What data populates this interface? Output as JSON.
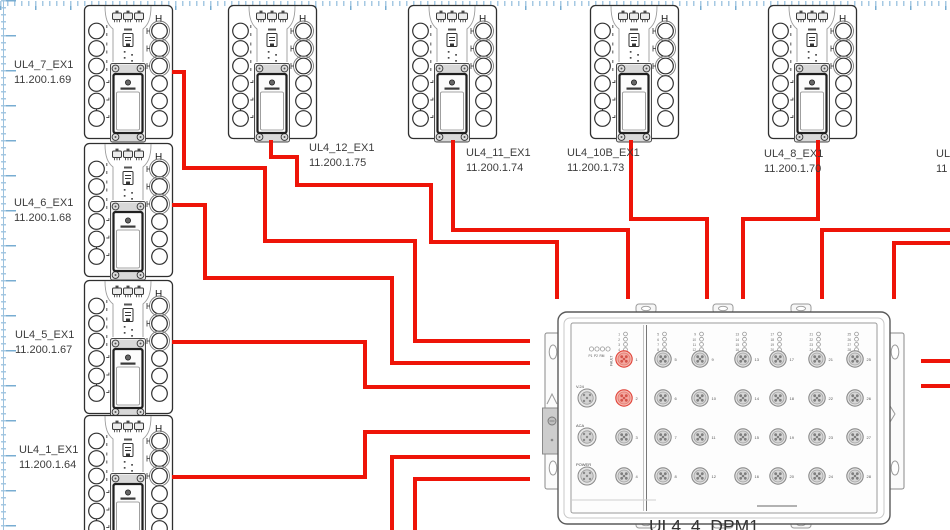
{
  "canvas": {
    "width": 950,
    "height": 530,
    "background": "#ffffff",
    "grid_tick_color": "#a6c9e3",
    "grid_major_color": "#78add2",
    "cable_color": "#ee1408",
    "highlight_port_fill": "#f6b9b1"
  },
  "ex_marker": "H",
  "devices": [
    {
      "name": "UL4_7_EX1",
      "ip": "11.200.1.69",
      "x": 84,
      "y": 5,
      "label_x": 14,
      "label_y": 58,
      "cable_exit": "right"
    },
    {
      "name": "UL4_6_EX1",
      "ip": "11.200.1.68",
      "x": 84,
      "y": 143,
      "label_x": 14,
      "label_y": 196,
      "cable_exit": "right"
    },
    {
      "name": "UL4_5_EX1",
      "ip": "11.200.1.67",
      "x": 84,
      "y": 280,
      "label_x": 15,
      "label_y": 328,
      "cable_exit": "right"
    },
    {
      "name": "UL4_1_EX1",
      "ip": "11.200.1.64",
      "x": 84,
      "y": 415,
      "label_x": 19,
      "label_y": 443,
      "cable_exit": "right"
    },
    {
      "name": "UL4_12_EX1",
      "ip": "11.200.1.75",
      "x": 228,
      "y": 5,
      "label_x": 309,
      "label_y": 141,
      "cable_exit": "bottom"
    },
    {
      "name": "UL4_11_EX1",
      "ip": "11.200.1.74",
      "x": 408,
      "y": 5,
      "label_x": 466,
      "label_y": 146,
      "cable_exit": "bottom"
    },
    {
      "name": "UL4_10B_EX1",
      "ip": "11.200.1.73",
      "x": 590,
      "y": 5,
      "label_x": 567,
      "label_y": 146,
      "cable_exit": "bottom"
    },
    {
      "name": "UL4_8_EX1",
      "ip": "11.200.1.70",
      "x": 768,
      "y": 5,
      "label_x": 764,
      "label_y": 147,
      "cable_exit": "bottom"
    }
  ],
  "edge_label": {
    "line1": "UL",
    "line2": "11",
    "x": 936,
    "y": 147
  },
  "dpm": {
    "name": "UL4_4_DPM1",
    "label_x": 649,
    "label_y": 516,
    "status_led_labels": [
      "P1",
      "P2",
      "RM"
    ],
    "fault_label": "FAULT",
    "connector_labels": [
      "V.24",
      "ACA",
      "POWER"
    ],
    "port_numbers": [
      "1",
      "2",
      "3",
      "4",
      "5",
      "6",
      "7",
      "8",
      "9",
      "10",
      "11",
      "12",
      "13",
      "14",
      "15",
      "16",
      "17",
      "18",
      "19",
      "20",
      "21",
      "22",
      "23",
      "24",
      "25",
      "26",
      "27",
      "28"
    ],
    "highlighted_ports": [
      "1",
      "2"
    ]
  },
  "cables": [
    {
      "points": [
        [
          172,
          72
        ],
        [
          184,
          72
        ],
        [
          184,
          168
        ],
        [
          265,
          168
        ],
        [
          265,
          241
        ],
        [
          415,
          241
        ],
        [
          415,
          341
        ],
        [
          530,
          341
        ]
      ]
    },
    {
      "points": [
        [
          172,
          205
        ],
        [
          205,
          205
        ],
        [
          205,
          278
        ],
        [
          392,
          278
        ],
        [
          392,
          363
        ],
        [
          530,
          363
        ]
      ]
    },
    {
      "points": [
        [
          172,
          342
        ],
        [
          365,
          342
        ],
        [
          365,
          387
        ],
        [
          530,
          387
        ]
      ]
    },
    {
      "points": [
        [
          172,
          477
        ],
        [
          365,
          477
        ],
        [
          365,
          432
        ],
        [
          530,
          432
        ]
      ]
    },
    {
      "points": [
        [
          392,
          532
        ],
        [
          392,
          457
        ],
        [
          530,
          457
        ]
      ]
    },
    {
      "points": [
        [
          415,
          532
        ],
        [
          415,
          479
        ],
        [
          530,
          479
        ]
      ]
    },
    {
      "points": [
        [
          271,
          140
        ],
        [
          271,
          157
        ],
        [
          297,
          157
        ],
        [
          297,
          185
        ],
        [
          431,
          185
        ],
        [
          431,
          242
        ],
        [
          557,
          242
        ],
        [
          557,
          299
        ]
      ]
    },
    {
      "points": [
        [
          453,
          140
        ],
        [
          453,
          230
        ],
        [
          628,
          230
        ],
        [
          628,
          299
        ]
      ]
    },
    {
      "points": [
        [
          631,
          140
        ],
        [
          631,
          219
        ],
        [
          707,
          219
        ],
        [
          707,
          299
        ]
      ]
    },
    {
      "points": [
        [
          818,
          140
        ],
        [
          818,
          219
        ],
        [
          743,
          219
        ],
        [
          743,
          299
        ]
      ]
    },
    {
      "points": [
        [
          952,
          230
        ],
        [
          822,
          230
        ],
        [
          822,
          299
        ]
      ]
    },
    {
      "points": [
        [
          952,
          243
        ],
        [
          894,
          243
        ],
        [
          894,
          299
        ]
      ]
    },
    {
      "points": [
        [
          952,
          361
        ],
        [
          921,
          361
        ]
      ]
    },
    {
      "points": [
        [
          952,
          386
        ],
        [
          921,
          386
        ]
      ]
    }
  ]
}
